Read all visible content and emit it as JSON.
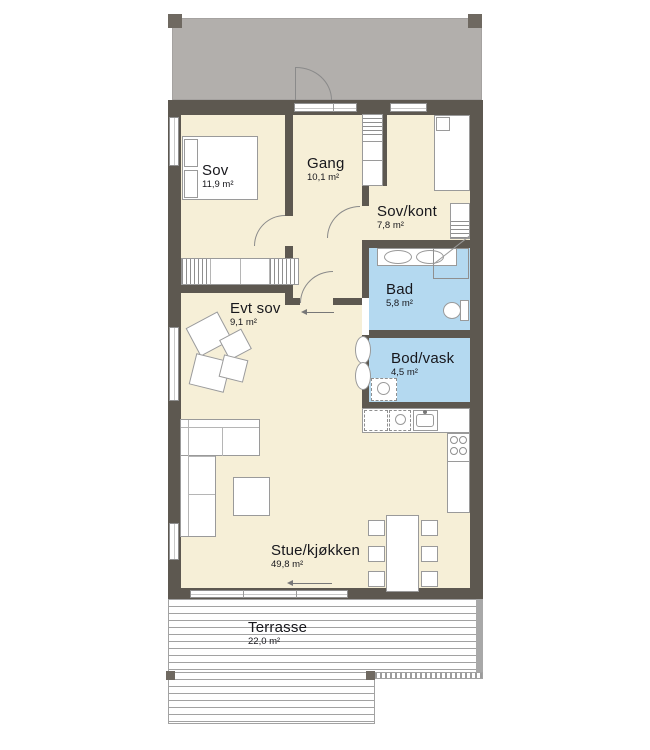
{
  "rooms": [
    {
      "name": "Sov",
      "area": "11,9 m²"
    },
    {
      "name": "Gang",
      "area": "10,1 m²"
    },
    {
      "name": "Sov/kont",
      "area": "7,8 m²"
    },
    {
      "name": "Bad",
      "area": "5,8 m²"
    },
    {
      "name": "Bod/vask",
      "area": "4,5 m²"
    },
    {
      "name": "Evt sov",
      "area": "9,1 m²"
    },
    {
      "name": "Stue/kjøkken",
      "area": "49,8 m²"
    },
    {
      "name": "Terrasse",
      "area": "22,0 m²"
    }
  ],
  "colors": {
    "room_fill": "#f6efd7",
    "wet_room_fill": "#b4d9f0",
    "wall": "#5d5850",
    "carport_fill": "#b2afac",
    "text": "#17171c"
  }
}
